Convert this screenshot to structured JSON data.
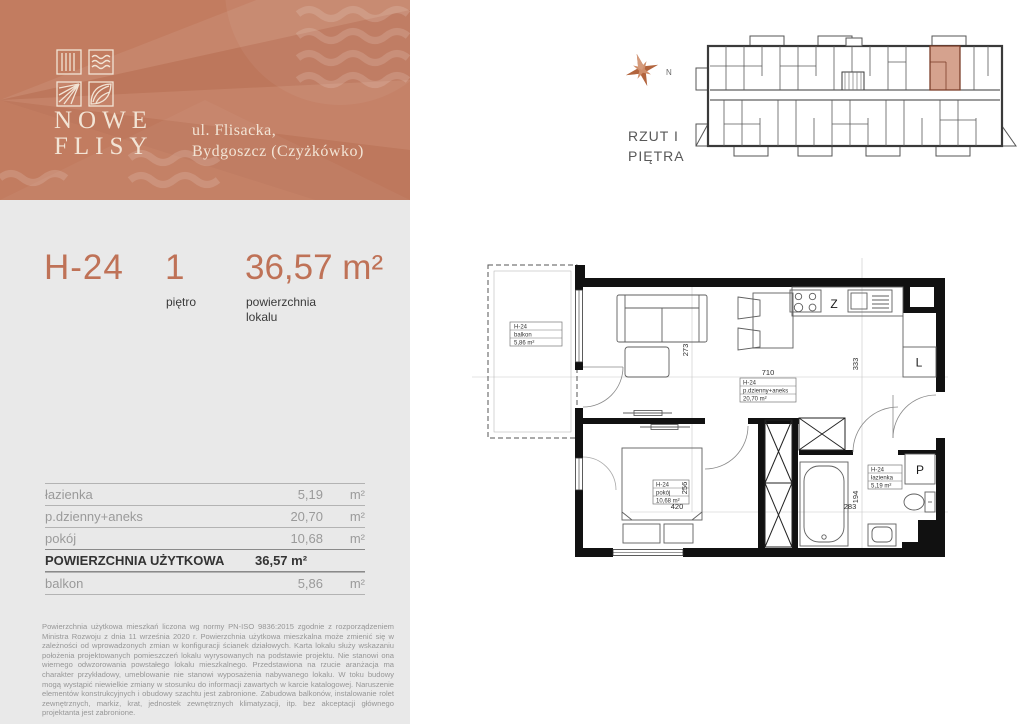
{
  "header": {
    "brand_line1": "NOWE",
    "brand_line2": "FLISY",
    "address_line1": "ul. Flisacka,",
    "address_line2": "Bydgoszcz (Czyżkówko)"
  },
  "unit": {
    "code": "H-24",
    "floor_value": "1",
    "floor_label": "piętro",
    "area_value": "36,57 m²",
    "area_label_line1": "powierzchnia",
    "area_label_line2": "lokalu"
  },
  "rooms_table": {
    "rows": [
      {
        "label": "łazienka",
        "value": "5,19",
        "unit": "m²"
      },
      {
        "label": "p.dzienny+aneks",
        "value": "20,70",
        "unit": "m²"
      },
      {
        "label": "pokój",
        "value": "10,68",
        "unit": "m²"
      }
    ],
    "total_label": "POWIERZCHNIA UŻYTKOWA",
    "total_value": "36,57 m²",
    "balcony_label": "balkon",
    "balcony_value": "5,86",
    "balcony_unit": "m²"
  },
  "disclaimer": "Powierzchnia użytkowa mieszkań liczona wg normy PN-ISO 9836:2015 zgodnie z rozporządzeniem Ministra Rozwoju z dnia 11 września 2020 r. Powierzchnia użytkowa mieszkalna może zmienić się w zależności od wprowadzonych zmian w konfiguracji ścianek działowych. Karta lokalu służy wskazaniu położenia projektowanych pomieszczeń lokalu wyrysowanych na podstawie projektu. Nie stanowi ona wiernego odwzorowania powstałego lokalu mieszkalnego. Przedstawiona na rzucie aranżacja ma charakter przykładowy, umeblowanie nie stanowi wyposażenia nabywanego lokalu. W toku budowy mogą wystąpić niewielkie zmiany w stosunku do informacji zawartych w karcie katalogowej. Naruszenie elementów konstrukcyjnych i obudowy szachtu jest zabronione. Zabudowa balkonów, instalowanie rolet zewnętrznych, markiz, krat, jednostek zewnętrznych klimatyzacji, itp. bez akceptacji głównego projektanta jest zabronione.",
  "overview": {
    "compass_label": "N",
    "caption_line1": "RZUT I",
    "caption_line2": "PIĘTRA"
  },
  "floorplan": {
    "balcony_tag": {
      "code": "H-24",
      "name": "balkon",
      "area": "5,86 m²"
    },
    "living_tag": {
      "code": "H-24",
      "name": "p.dzienny+aneks",
      "area": "20,70 m²"
    },
    "room_tag": {
      "code": "H-24",
      "name": "pokój",
      "area": "10,68 m²"
    },
    "bath_tag": {
      "code": "H-24",
      "name": "łazienka",
      "area": "5,19 m²"
    },
    "dims": {
      "living_w": "710",
      "living_h": "273",
      "kitchen_h": "333",
      "room_h": "256",
      "room_w": "420",
      "bath_h": "194",
      "bath_w": "283"
    },
    "appliances": {
      "dishwasher": "Z",
      "fridge": "L",
      "washer": "P"
    }
  },
  "colors": {
    "accent": "#bf7257",
    "header_bg": "#c27c60",
    "panel_bg": "#e9e9e9",
    "unit_highlight": "#d5a28e",
    "wall": "#111111"
  }
}
